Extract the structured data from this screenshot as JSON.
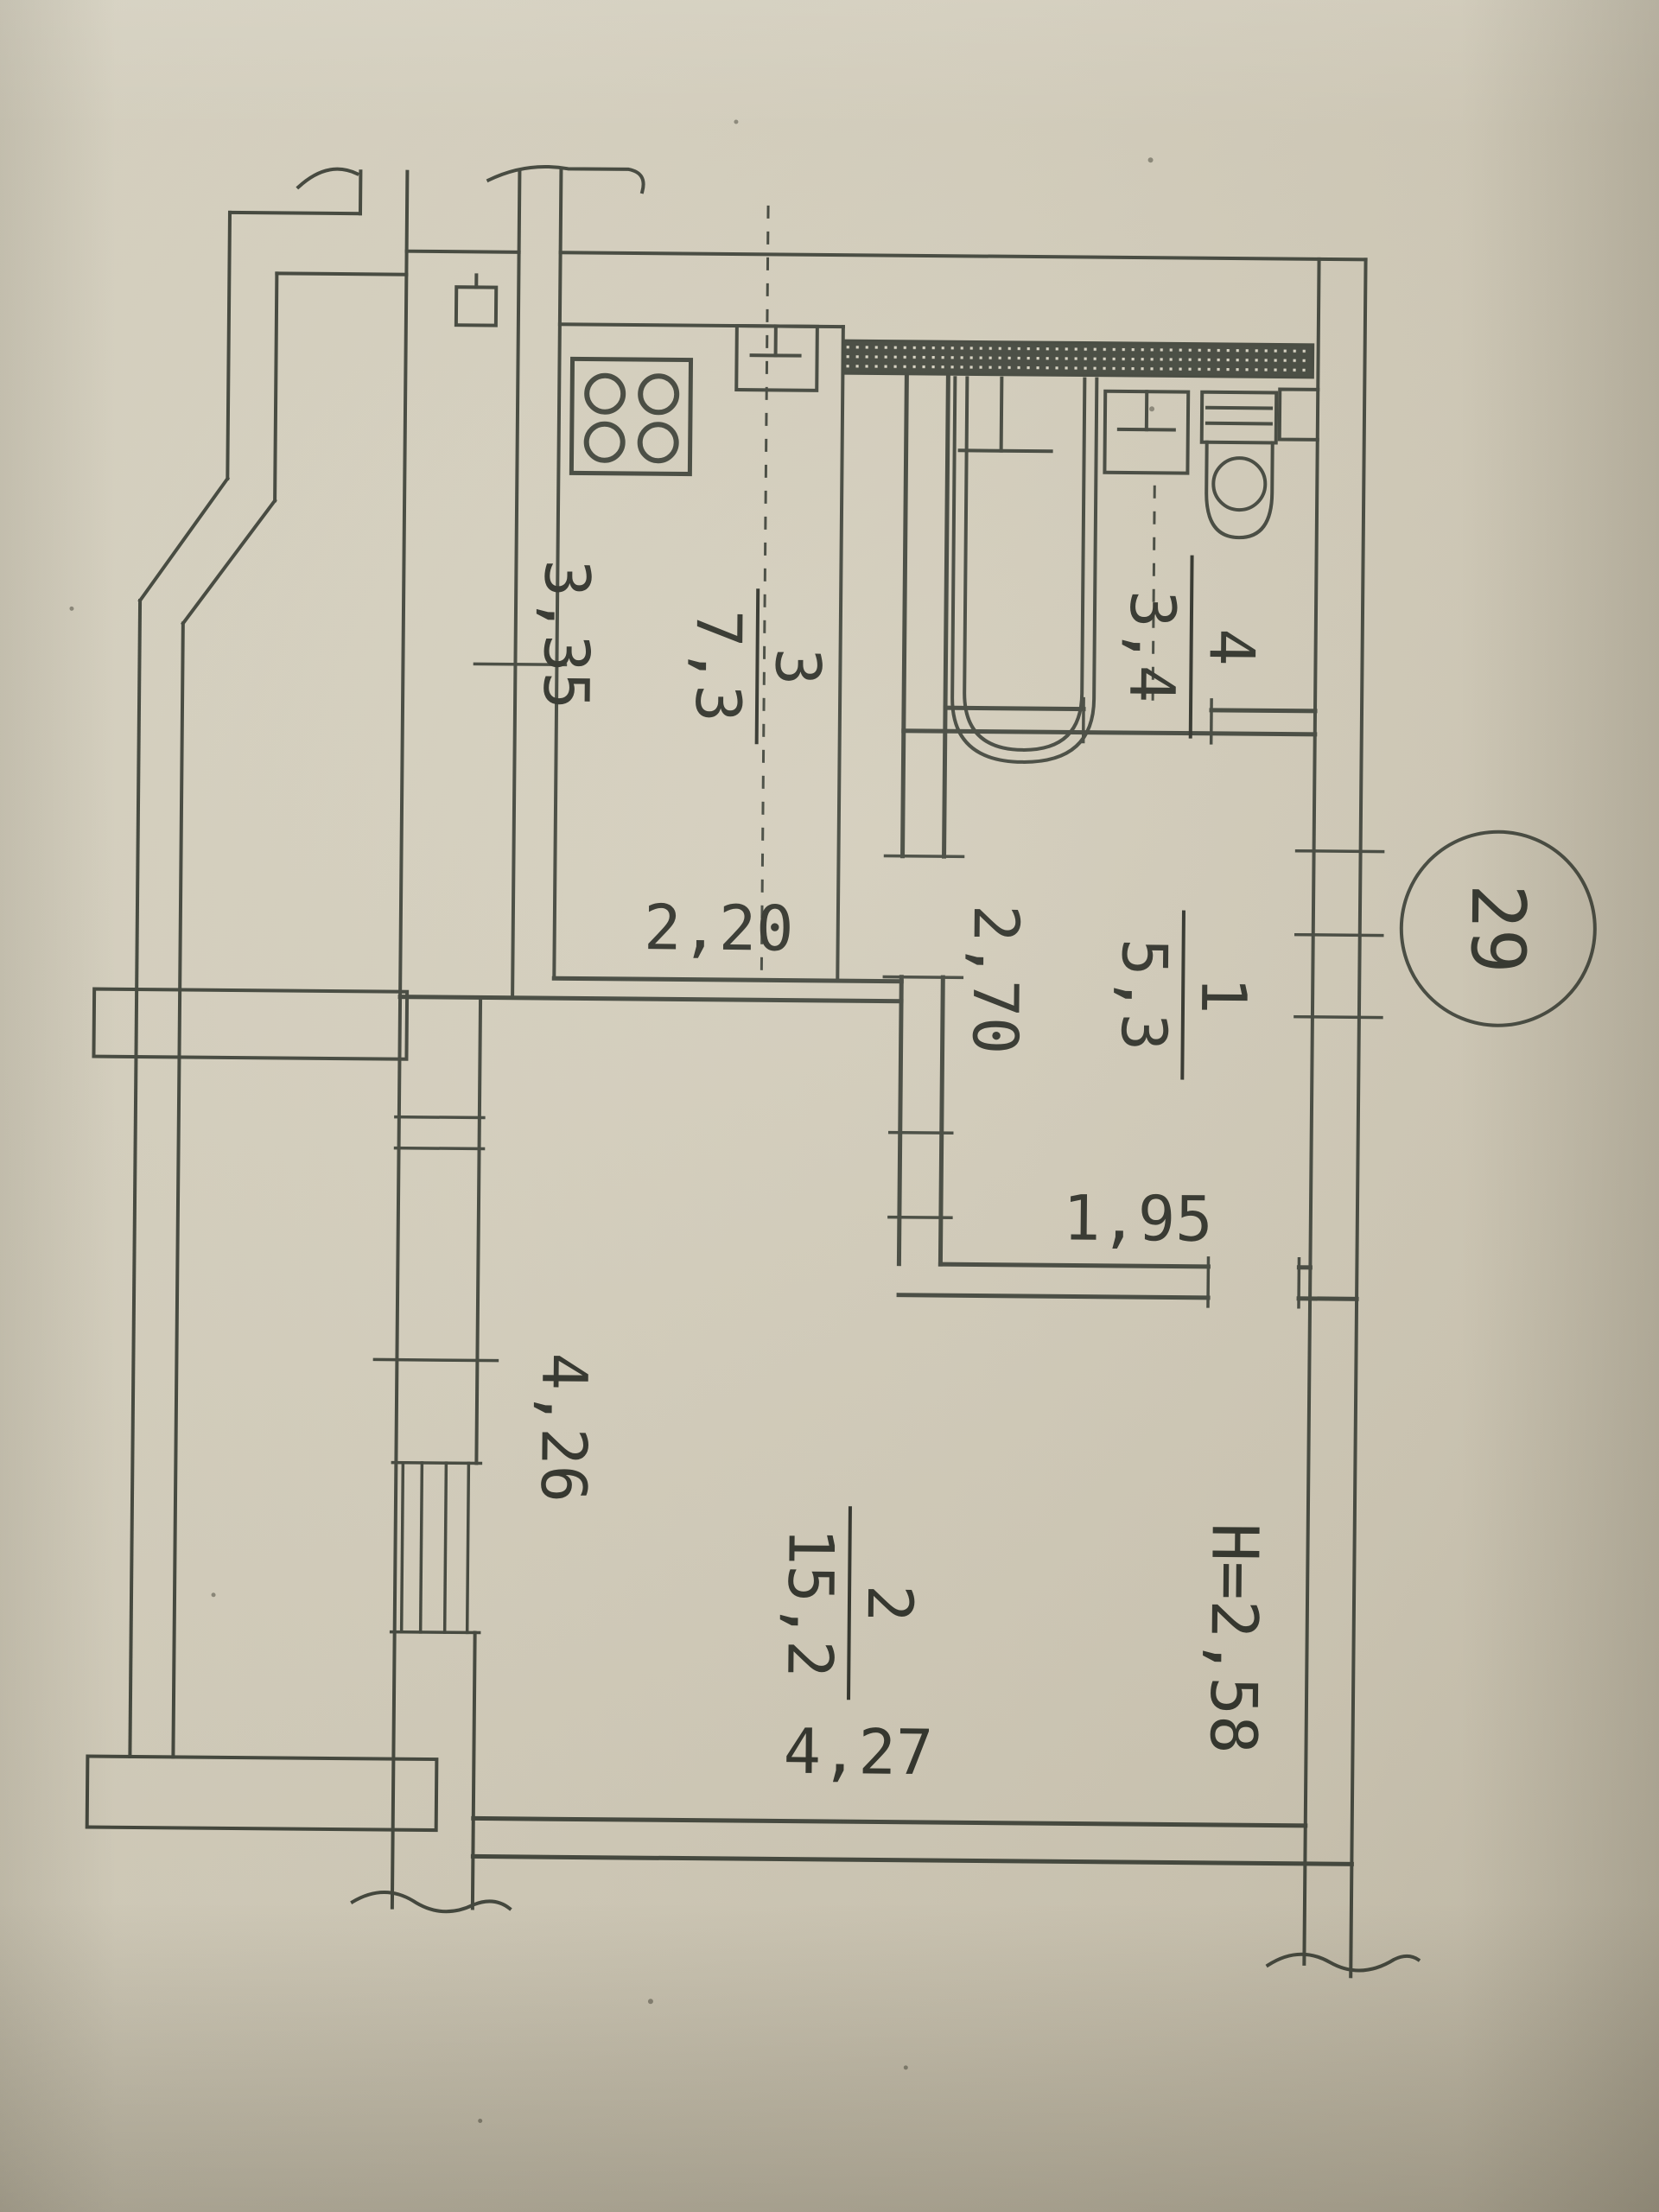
{
  "badge": {
    "number": "29"
  },
  "rooms": {
    "bathroom": {
      "number": "4",
      "area": "3,4"
    },
    "kitchen": {
      "number": "3",
      "area": "7,3"
    },
    "hallway": {
      "number": "1",
      "area": "5,3"
    },
    "living": {
      "number": "2",
      "area": "15,2"
    }
  },
  "labels": {
    "dim_3_35": "3,35",
    "dim_2_20": "2,20",
    "dim_2_70": "2,70",
    "dim_1_95": "1,95",
    "dim_4_26": "4,26",
    "dim_4_27": "4,27",
    "ceiling_height": "H=2,58"
  },
  "colors": {
    "paper": "#d3cdbb",
    "ink": "#3f4339",
    "ink_dark": "#2c2e26"
  }
}
